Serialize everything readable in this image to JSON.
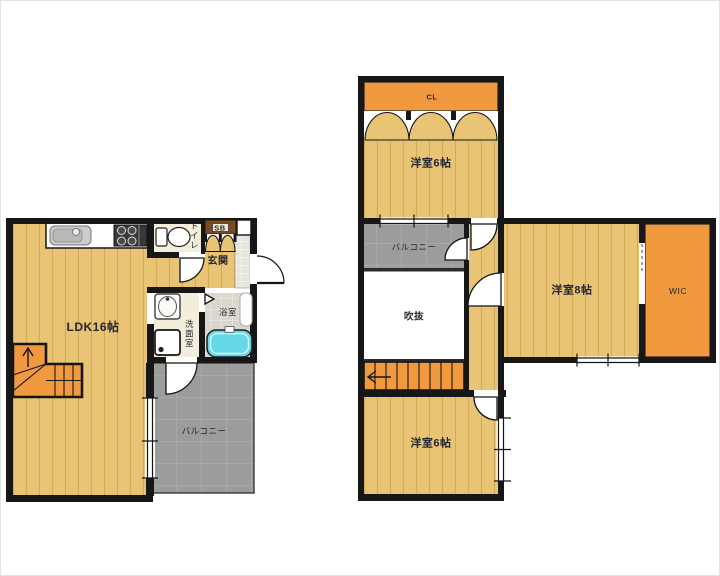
{
  "colors": {
    "wall": "#171717",
    "wood": "#e9c475",
    "wood_line": "#c79f4c",
    "orange": "#f0993f",
    "balcony": "#9c9c9c",
    "balcony_line": "#bcbcbc",
    "cream": "#f2eedb",
    "bath_floor": "#dbd7cc",
    "tile": "#e7e5df",
    "tub": "#66d9e8",
    "brown": "#7b4b20",
    "label": "#26262e"
  },
  "floor1": {
    "ldk": "LDK16帖",
    "toilet": "トイレ",
    "shoe_box": "SB",
    "entrance": "玄関",
    "washroom": "洗面室",
    "bathroom": "浴室",
    "balcony": "バルコニー"
  },
  "floor2": {
    "closet": "CL",
    "bedroom_north": "洋室6帖",
    "balcony": "バルコニー",
    "atrium": "吹抜",
    "bedroom_east": "洋室8帖",
    "walk_in_closet": "WIC",
    "bedroom_south": "洋室6帖"
  }
}
